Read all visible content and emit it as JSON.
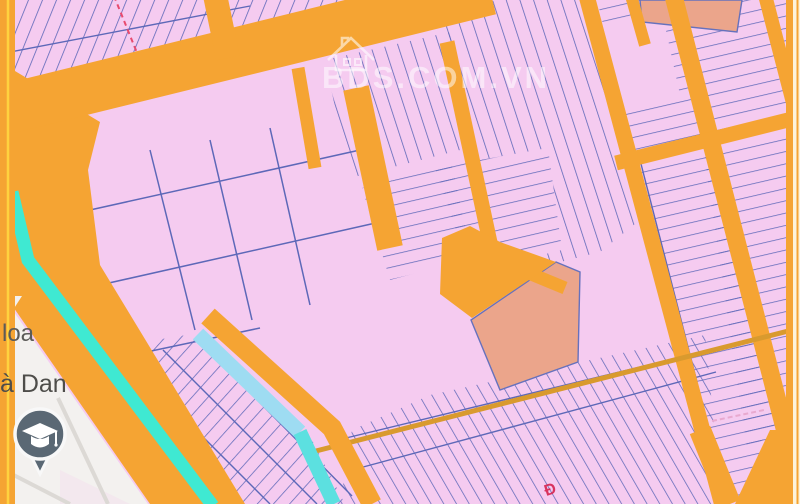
{
  "watermark": {
    "text": "BDS.COM.VN",
    "icon": "house-icon"
  },
  "map_labels": {
    "left_upper": "loa",
    "left_lower": "à Dan",
    "red_glyph": "Đ"
  },
  "marker": {
    "icon": "graduation-cap-icon",
    "type": "education-place-pin"
  },
  "palette": {
    "parcel_pink": "#f5cbf0",
    "parcel_salmon": "#eba58b",
    "road_orange": "#f5a433",
    "boundary_blue": "#5d68b8",
    "canal_cyan": "#3fe9d2",
    "channel_blue": "#9edcf2",
    "unzoned_white": "#f3f1ef",
    "edge_yellow": "#ffd23f",
    "pin_slate": "#5a6874"
  }
}
